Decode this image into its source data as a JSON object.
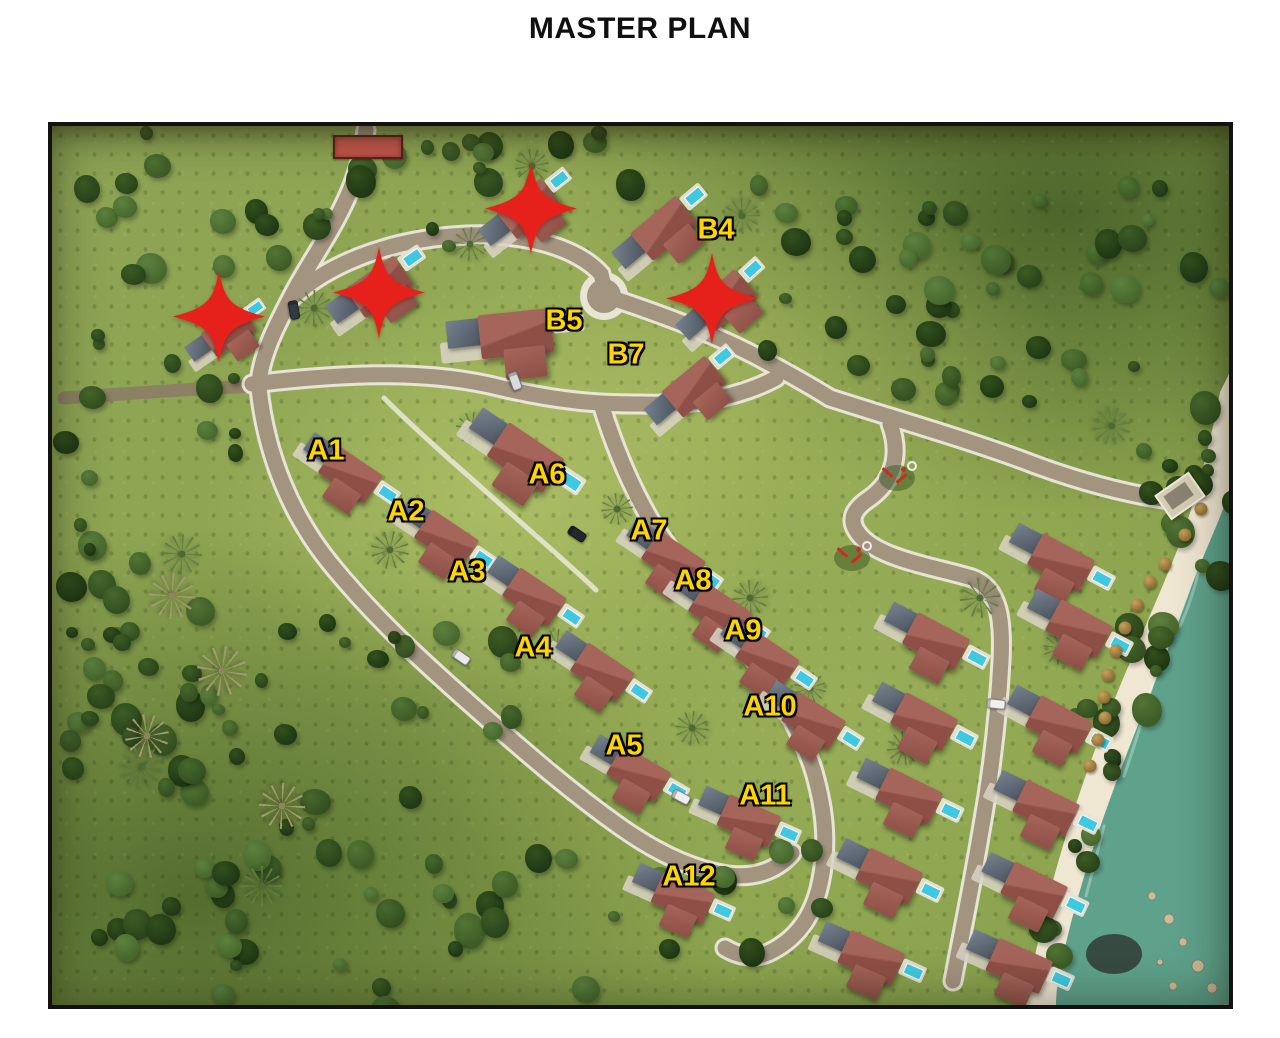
{
  "page": {
    "title": "MASTER PLAN"
  },
  "map": {
    "unit_labels": [
      {
        "id": "B4",
        "x": 664,
        "y": 104
      },
      {
        "id": "B5",
        "x": 512,
        "y": 195
      },
      {
        "id": "B7",
        "x": 574,
        "y": 229
      },
      {
        "id": "A1",
        "x": 274,
        "y": 325
      },
      {
        "id": "A2",
        "x": 354,
        "y": 386
      },
      {
        "id": "A3",
        "x": 415,
        "y": 446
      },
      {
        "id": "A4",
        "x": 481,
        "y": 522
      },
      {
        "id": "A5",
        "x": 572,
        "y": 620
      },
      {
        "id": "A6",
        "x": 495,
        "y": 349
      },
      {
        "id": "A7",
        "x": 597,
        "y": 405
      },
      {
        "id": "A8",
        "x": 641,
        "y": 455
      },
      {
        "id": "A9",
        "x": 691,
        "y": 505
      },
      {
        "id": "A10",
        "x": 718,
        "y": 581
      },
      {
        "id": "A11",
        "x": 713,
        "y": 670
      },
      {
        "id": "A12",
        "x": 637,
        "y": 751
      }
    ],
    "sold_markers": [
      {
        "x": 167,
        "y": 193
      },
      {
        "x": 327,
        "y": 169
      },
      {
        "x": 479,
        "y": 85
      },
      {
        "x": 660,
        "y": 175
      }
    ],
    "villas": [
      {
        "x": 172,
        "y": 210,
        "r": -35,
        "s": 0.85
      },
      {
        "x": 322,
        "y": 166,
        "r": -35,
        "s": 1.05
      },
      {
        "x": 472,
        "y": 88,
        "r": -38,
        "s": 1
      },
      {
        "x": 607,
        "y": 108,
        "r": -40,
        "s": 1.05
      },
      {
        "x": 668,
        "y": 180,
        "r": -42,
        "s": 1
      },
      {
        "x": 455,
        "y": 210,
        "r": -6,
        "s": 1.3
      },
      {
        "x": 637,
        "y": 266,
        "r": -40,
        "s": 1
      },
      {
        "x": 292,
        "y": 345,
        "r": 34,
        "s": 1
      },
      {
        "x": 388,
        "y": 410,
        "r": 34,
        "s": 1
      },
      {
        "x": 476,
        "y": 468,
        "r": 34,
        "s": 1
      },
      {
        "x": 544,
        "y": 543,
        "r": 34,
        "s": 1
      },
      {
        "x": 580,
        "y": 645,
        "r": 30,
        "s": 1
      },
      {
        "x": 466,
        "y": 328,
        "r": 34,
        "s": 1.2
      },
      {
        "x": 615,
        "y": 431,
        "r": 34,
        "s": 1
      },
      {
        "x": 662,
        "y": 483,
        "r": 34,
        "s": 1
      },
      {
        "x": 709,
        "y": 530,
        "r": 34,
        "s": 1
      },
      {
        "x": 755,
        "y": 592,
        "r": 32,
        "s": 1
      },
      {
        "x": 690,
        "y": 693,
        "r": 24,
        "s": 1
      },
      {
        "x": 624,
        "y": 770,
        "r": 24,
        "s": 1
      },
      {
        "x": 1002,
        "y": 434,
        "r": 28,
        "s": 1.05
      },
      {
        "x": 877,
        "y": 513,
        "r": 28,
        "s": 1.05
      },
      {
        "x": 1020,
        "y": 500,
        "r": 28,
        "s": 1.05
      },
      {
        "x": 865,
        "y": 593,
        "r": 28,
        "s": 1.05
      },
      {
        "x": 1000,
        "y": 596,
        "r": 28,
        "s": 1.05
      },
      {
        "x": 850,
        "y": 668,
        "r": 26,
        "s": 1.05
      },
      {
        "x": 987,
        "y": 680,
        "r": 26,
        "s": 1.05
      },
      {
        "x": 830,
        "y": 748,
        "r": 26,
        "s": 1.05
      },
      {
        "x": 975,
        "y": 762,
        "r": 26,
        "s": 1.05
      },
      {
        "x": 812,
        "y": 830,
        "r": 24,
        "s": 1.05
      },
      {
        "x": 960,
        "y": 838,
        "r": 24,
        "s": 1.05
      }
    ],
    "beach_umbrellas": [
      {
        "x": 1149,
        "y": 383
      },
      {
        "x": 1133,
        "y": 409
      },
      {
        "x": 1113,
        "y": 438
      },
      {
        "x": 1098,
        "y": 456
      },
      {
        "x": 1085,
        "y": 479
      },
      {
        "x": 1073,
        "y": 502
      },
      {
        "x": 1064,
        "y": 525
      },
      {
        "x": 1056,
        "y": 549
      },
      {
        "x": 1052,
        "y": 571
      },
      {
        "x": 1053,
        "y": 592
      },
      {
        "x": 1046,
        "y": 614
      },
      {
        "x": 1038,
        "y": 640
      }
    ],
    "cars": [
      {
        "x": 242,
        "y": 184,
        "r": 80,
        "c": "#343a42"
      },
      {
        "x": 463,
        "y": 255,
        "r": 70,
        "c": "#d8dbdd"
      },
      {
        "x": 525,
        "y": 408,
        "r": 34,
        "c": "#23282e"
      },
      {
        "x": 409,
        "y": 531,
        "r": 34,
        "c": "#e8e9ea"
      },
      {
        "x": 629,
        "y": 671,
        "r": 28,
        "c": "#eceded"
      },
      {
        "x": 944,
        "y": 578,
        "r": 6,
        "c": "#f0f0ee"
      }
    ],
    "playgrounds": [
      {
        "x": 845,
        "y": 352
      },
      {
        "x": 800,
        "y": 432
      }
    ],
    "beach_deck": {
      "x": 1128,
      "y": 370,
      "rot": -35
    },
    "entrance_sign": {
      "x": 281,
      "y": 9,
      "w": 66,
      "h": 20
    },
    "colors": {
      "label_yellow": "#FFD500",
      "star_red": "#E6211B",
      "roof": "#A5655A",
      "roof_dark": "#8E4F46",
      "pool": "#3FC9E0",
      "pad": "#D9D3C5",
      "road": "#A39480",
      "road_edge": "#ECE8DC",
      "dirt": "#8C7D67",
      "grass": "#8DA455",
      "forest": "#2B451C",
      "sand": "#F0E7D3",
      "ocean": "#5FA28C",
      "sign_red": "#C9584D"
    }
  }
}
